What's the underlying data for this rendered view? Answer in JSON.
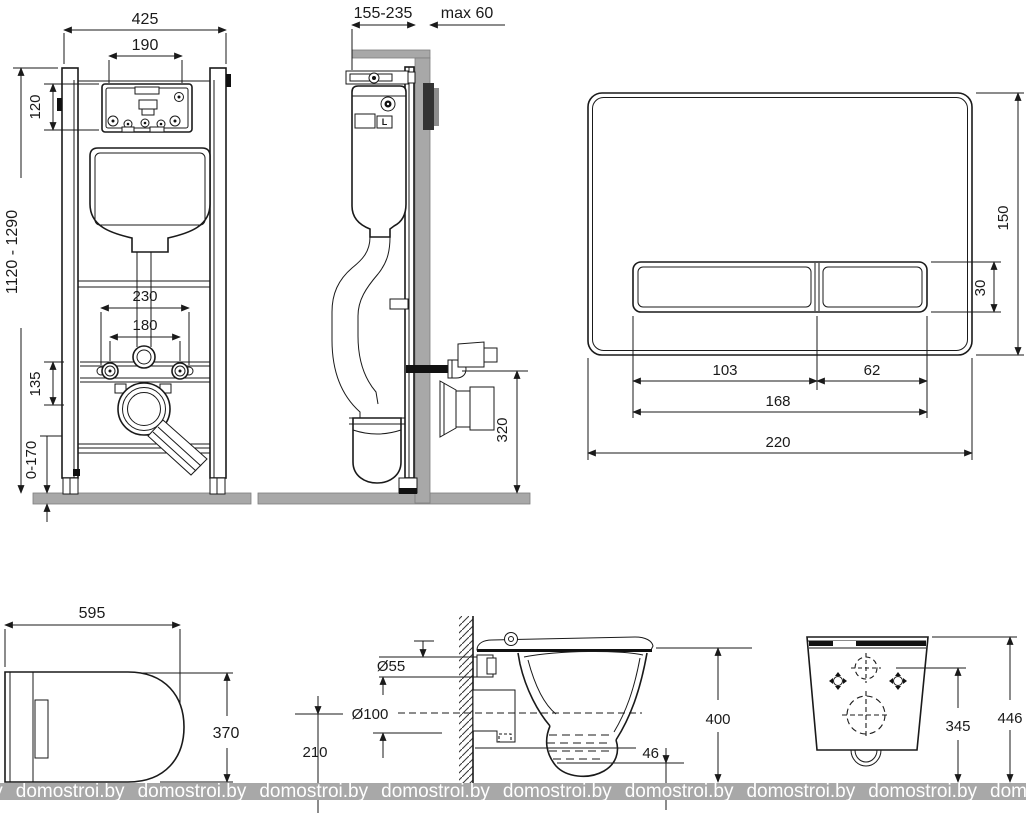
{
  "frame_front": {
    "overall_width": "425",
    "opening_width": "190",
    "panel_height": "120",
    "install_height": "1120 - 1290",
    "fixing_spacing_outer": "230",
    "fixing_spacing_inner": "180",
    "drain_offset": "135",
    "leg_adjustment": "0-170"
  },
  "frame_side": {
    "frame_depth": "155-235",
    "wall_allowance": "max 60",
    "drain_height": "320",
    "valve_label": "L"
  },
  "flush_plate": {
    "height": "150",
    "button_height": "30",
    "left_button_width": "103",
    "right_button_width": "62",
    "buttons_total_width": "168",
    "width": "220"
  },
  "bowl_top": {
    "length": "595",
    "width": "370"
  },
  "bowl_side": {
    "inlet_dia": "Ø55",
    "outlet_dia": "Ø100",
    "outlet_height": "210",
    "bottom_gap": "46",
    "overall_height": "400"
  },
  "bowl_back": {
    "fixing_height": "345",
    "overall_height": "446"
  },
  "watermark": {
    "text": "domostroi.by",
    "repeat": 10
  }
}
